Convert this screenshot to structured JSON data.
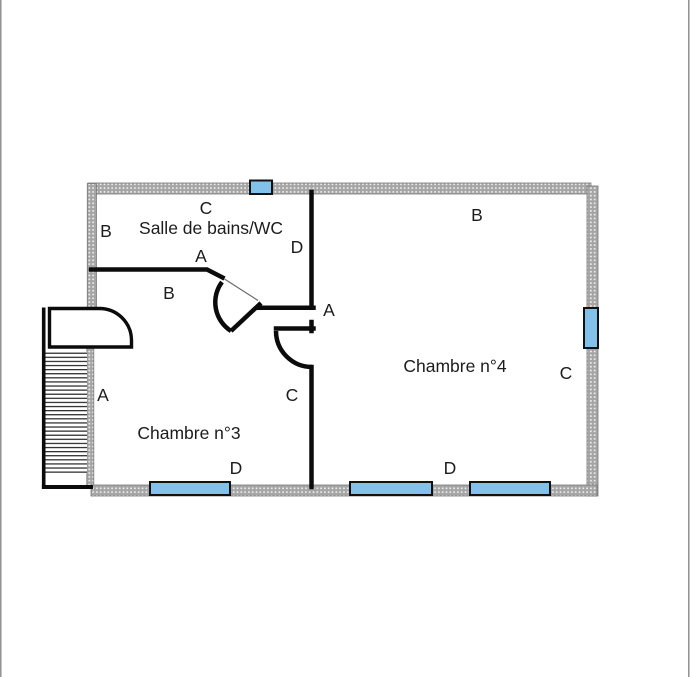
{
  "page": {
    "background": "#ffffff",
    "type_note": "architectural floor plan"
  },
  "colors": {
    "window_blue": "#82c2ea",
    "wall_hatch_gray": "#a5a5a5",
    "wall_line_black": "#0b0b0b",
    "label_color": "#1c1c1c",
    "edge_line_gray": "#8f8f8f"
  },
  "plan": {
    "room_labels": [
      {
        "id": "salle-de-bains-wc",
        "text": "Salle de bains/WC"
      },
      {
        "id": "chambre-3",
        "text": "Chambre n°3"
      },
      {
        "id": "chambre-4",
        "text": "Chambre n°4"
      }
    ],
    "wall_labels": [
      {
        "id": "c-top",
        "text": "C"
      },
      {
        "id": "b-left-top",
        "text": "B"
      },
      {
        "id": "a-bathroom",
        "text": "A"
      },
      {
        "id": "d-bathroom-right",
        "text": "D"
      },
      {
        "id": "b-right-room-top",
        "text": "B"
      },
      {
        "id": "b-chambre3-top",
        "text": "B"
      },
      {
        "id": "a-middle-wall",
        "text": "A"
      },
      {
        "id": "c-right-wall",
        "text": "C"
      },
      {
        "id": "a-left-wall",
        "text": "A"
      },
      {
        "id": "c-middle-lower",
        "text": "C"
      },
      {
        "id": "d-bottom-left",
        "text": "D"
      },
      {
        "id": "d-bottom-right",
        "text": "D"
      }
    ],
    "window_count": 5,
    "door_count": 3,
    "has_staircase": true
  }
}
